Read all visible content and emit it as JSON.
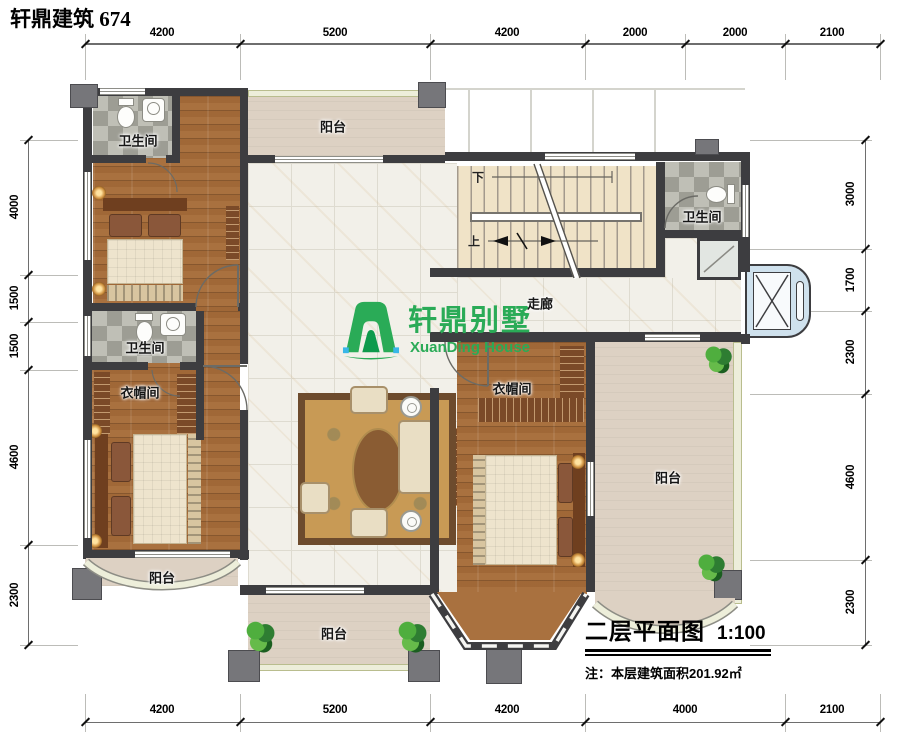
{
  "header": {
    "title": "轩鼎建筑  674"
  },
  "logo": {
    "name_cn": "轩鼎别墅",
    "name_en": "XuanDing House"
  },
  "title_block": {
    "plan_title": "二层平面图",
    "scale": "1:100",
    "note": "注：本层建筑面积201.92㎡"
  },
  "rooms": {
    "bath_top_left": "卫生间",
    "bath_mid_left": "卫生间",
    "bath_top_right": "卫生间",
    "cloakroom_left": "衣帽间",
    "cloakroom_right": "衣帽间",
    "corridor": "走廊",
    "balcony_top": "阳台",
    "balcony_bottom_left": "阳台",
    "balcony_bottom_center": "阳台",
    "balcony_right": "阳台"
  },
  "stairs": {
    "down_label": "下",
    "up_label": "上"
  },
  "dimensions": {
    "top": [
      "4200",
      "5200",
      "4200",
      "2000",
      "2000",
      "2100"
    ],
    "bottom": [
      "4200",
      "5200",
      "4200",
      "4000",
      "2100"
    ],
    "left": [
      "4000",
      "1500",
      "1500",
      "4600",
      "2300"
    ],
    "right": [
      "3000",
      "1700",
      "2300",
      "4600",
      "2300"
    ]
  },
  "colors": {
    "wall": "#3d3d40",
    "wood_floor": "#a9713f",
    "tile": "#f2f0e9",
    "balcony": "#ddd1c3",
    "accent_green": "#2aab57",
    "bay_blue": "#cfe1ed"
  }
}
